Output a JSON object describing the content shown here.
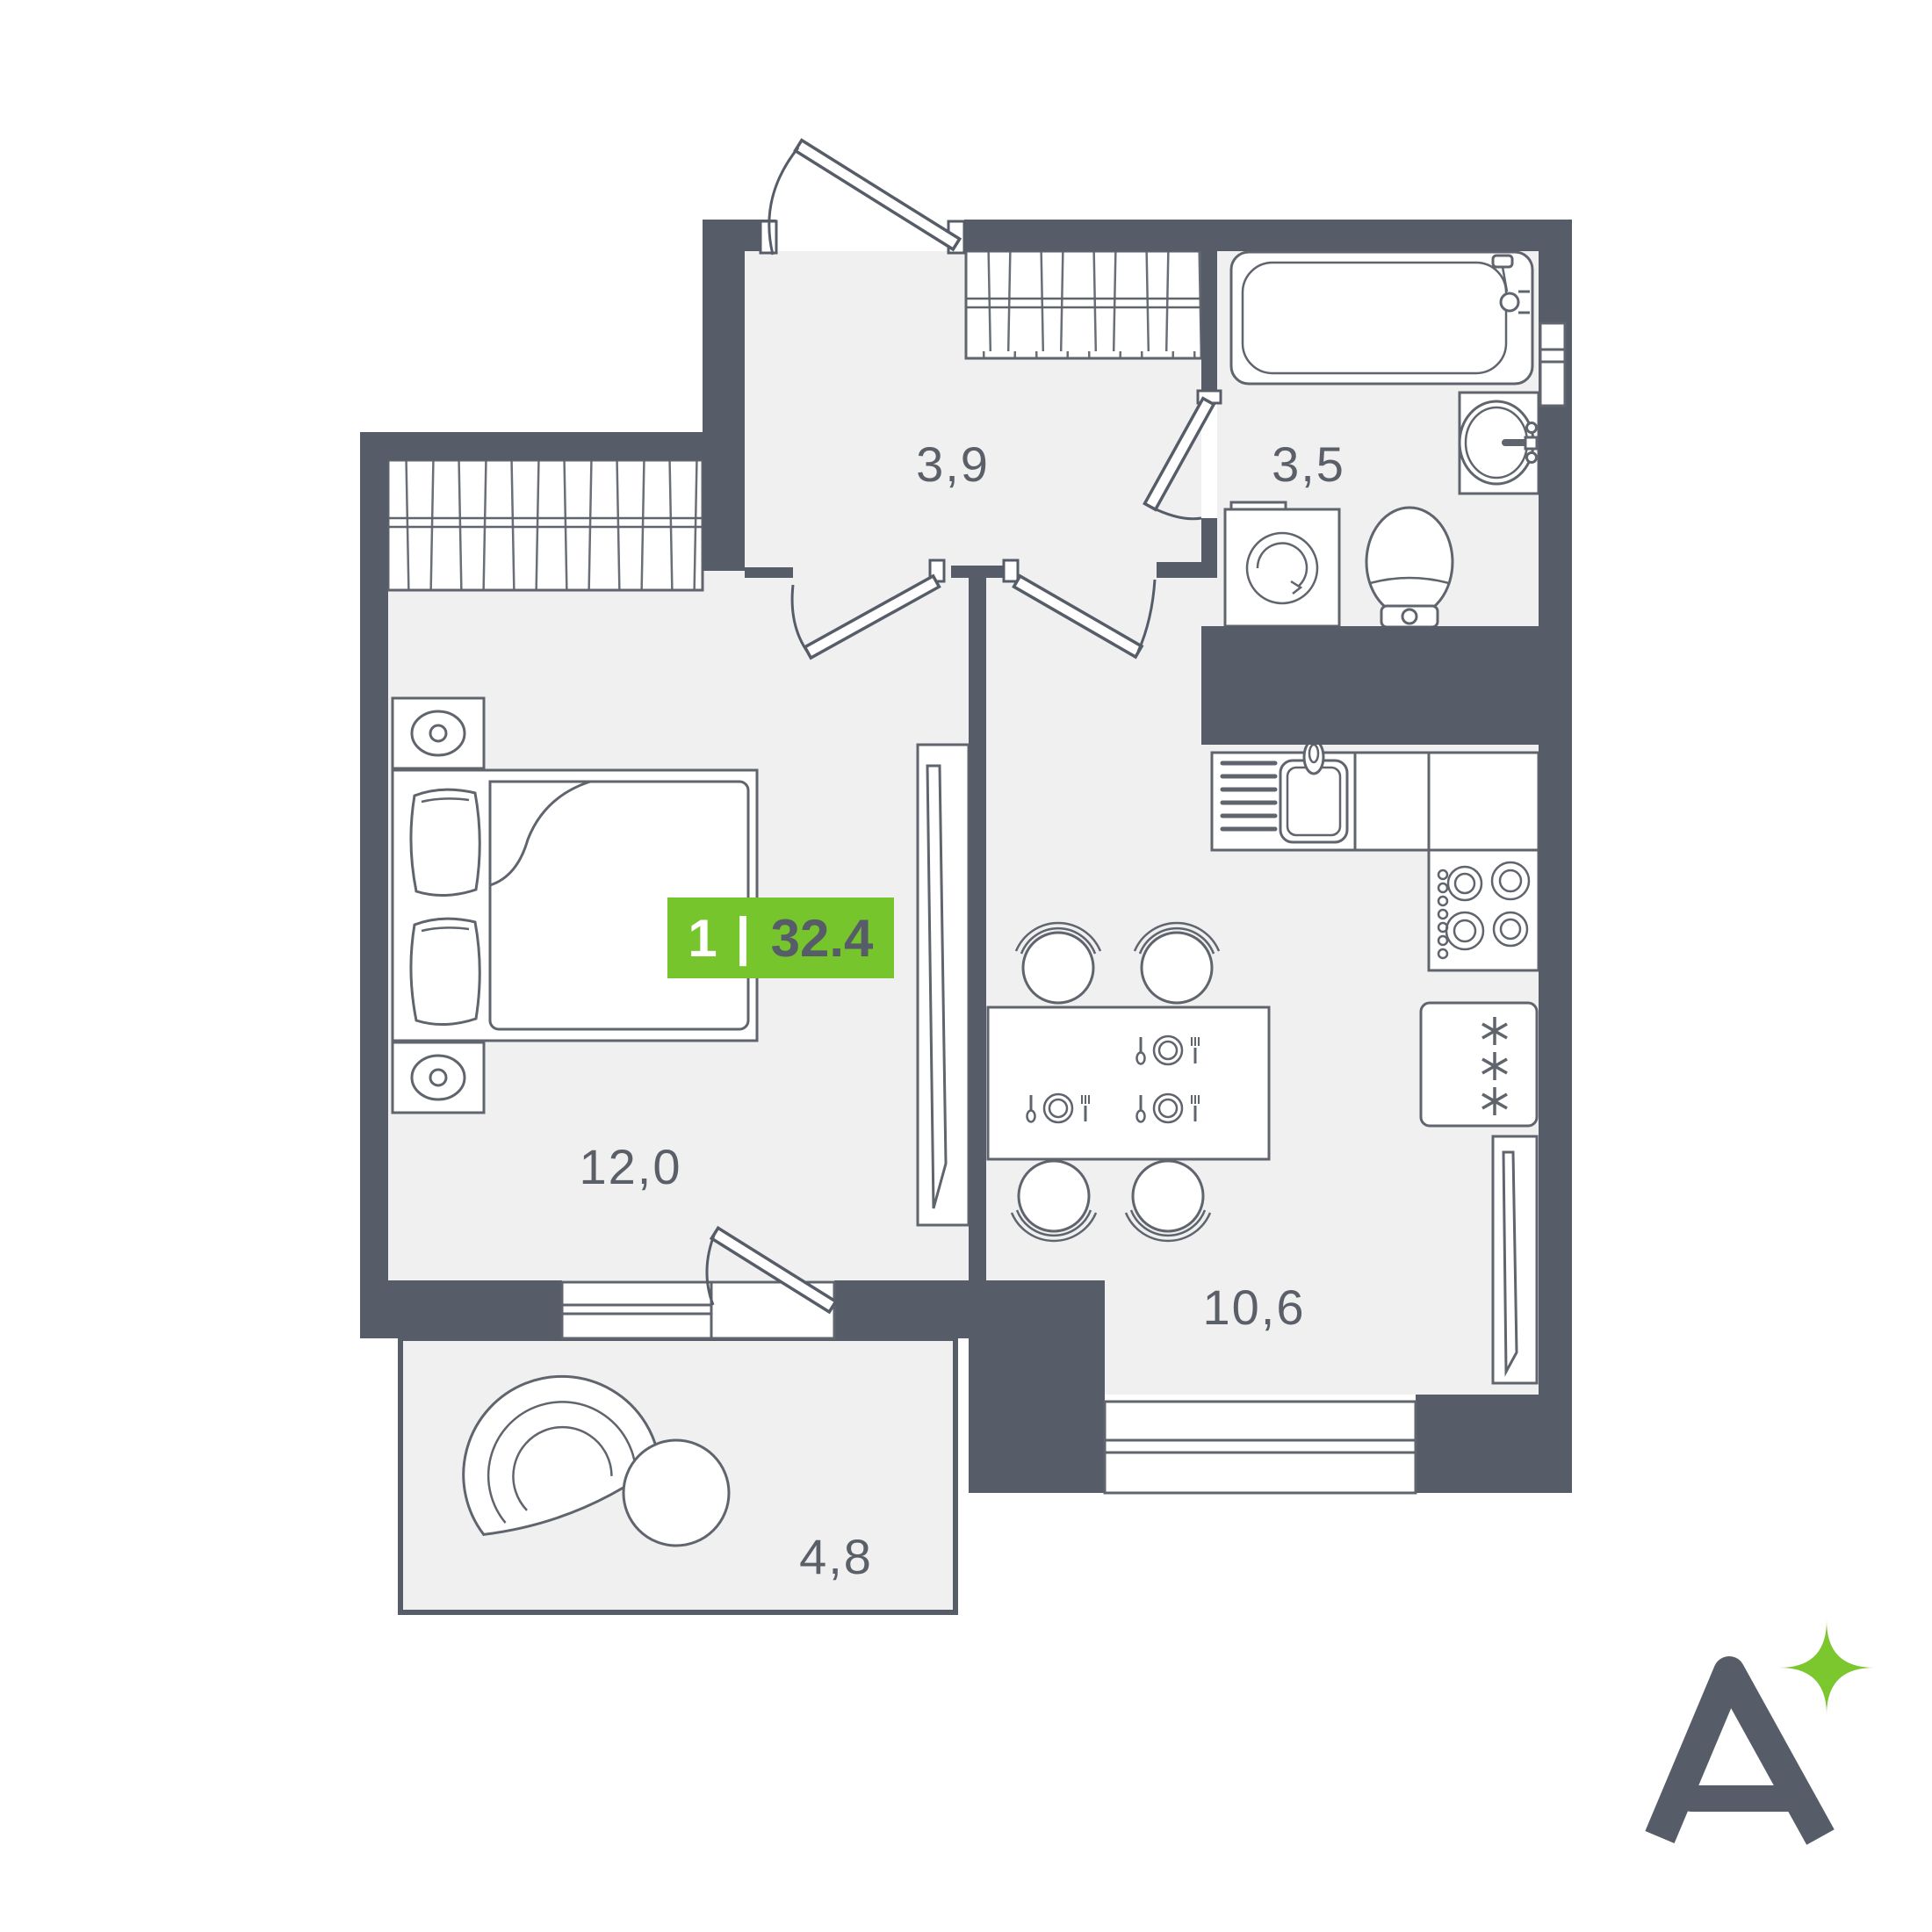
{
  "badge": {
    "rooms_count": "1",
    "divider": "|",
    "total_area": "32.4"
  },
  "rooms": {
    "hallway": {
      "area": "3,9"
    },
    "bathroom": {
      "area": "3,5"
    },
    "bedroom": {
      "area": "12,0"
    },
    "kitchen_living": {
      "area": "10,6"
    },
    "balcony": {
      "area": "4,8"
    }
  },
  "logo": {
    "letter": "A",
    "sparkle": "four-point-star"
  },
  "icons": {
    "furniture": [
      "bed",
      "pillow",
      "nightstand-lamp",
      "wardrobe-hatch",
      "mirror-cabinet",
      "bathtub",
      "washbasin",
      "washing-machine",
      "toilet",
      "kitchen-sink",
      "countertop",
      "stove-burners",
      "fridge-snowflakes",
      "radiator",
      "dining-table",
      "chair",
      "place-setting",
      "lounge-chair",
      "coffee-table",
      "door-leaf",
      "door-swing-arc",
      "window"
    ]
  },
  "colors": {
    "background": "#FFFFFF",
    "wall": "#575D68",
    "floor": "#F0F0F1",
    "furniture_line": "#5F646D",
    "label_text": "#5A5F68",
    "badge_bg": "#76C52D",
    "badge_rooms_text": "#FFFFFF",
    "badge_area_text": "#575D68",
    "logo_mark": "#575D68",
    "logo_sparkle": "#7CC62E"
  }
}
